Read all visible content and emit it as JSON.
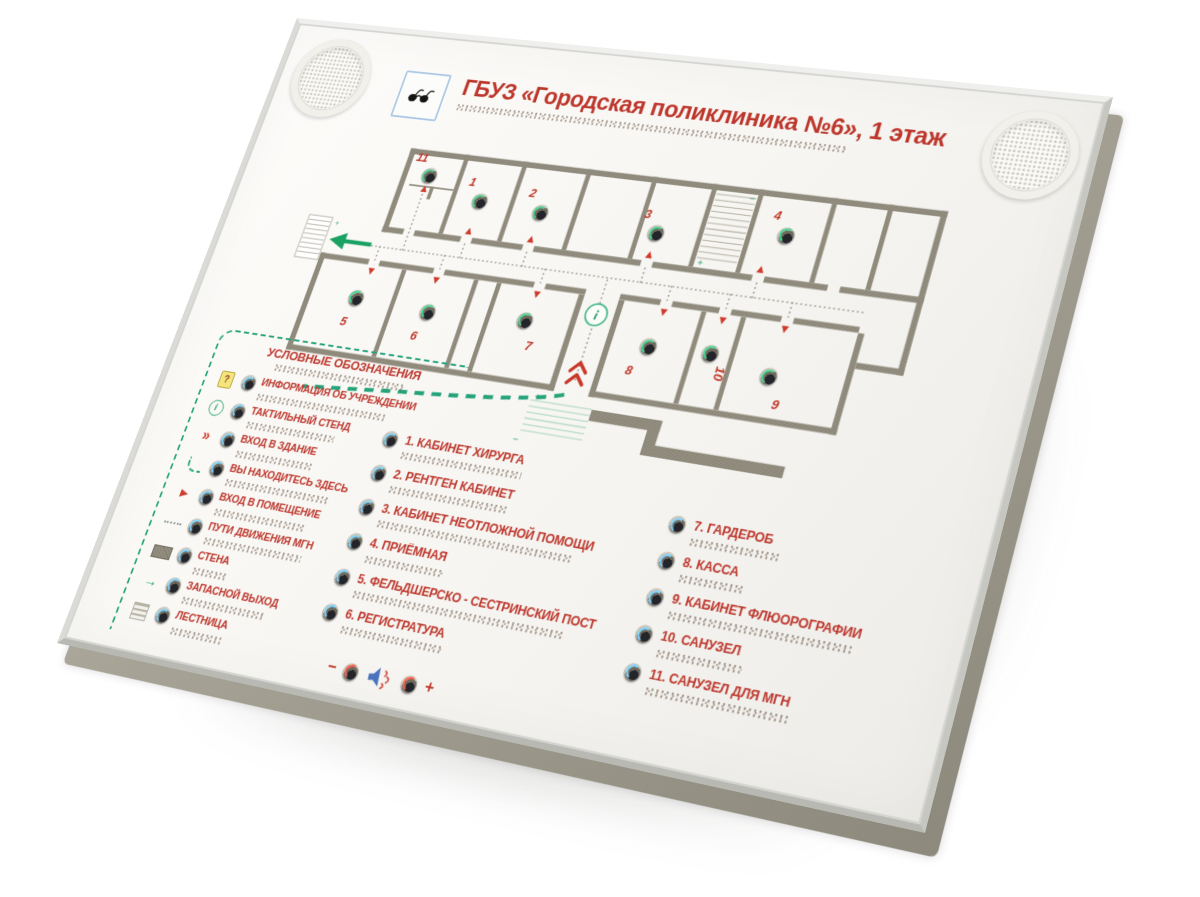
{
  "board": {
    "title": "ГБУЗ «Городская поликлиника №6», 1 этаж"
  },
  "legend": {
    "title": "УСЛОВНЫЕ ОБОЗНАЧЕНИЯ",
    "icons": {
      "question": "?",
      "info": "i",
      "chevron": "»",
      "green_arrow": "→"
    },
    "items": [
      {
        "icon": "question-sign-icon",
        "label": "ИНФОРМАЦИЯ ОБ УЧРЕЖДЕНИИ"
      },
      {
        "icon": "info-point-icon",
        "label": "ТАКТИЛЬНЫЙ СТЕНД"
      },
      {
        "icon": "double-chevron-icon",
        "label": "ВХОД В ЗДАНИЕ"
      },
      {
        "icon": "dashed-route-end-icon",
        "label": "ВЫ НАХОДИТЕСЬ ЗДЕСЬ"
      },
      {
        "icon": "entry-arrow-icon",
        "label": "ВХОД В ПОМЕЩЕНИЕ"
      },
      {
        "icon": "dotted-route-icon",
        "label": "ПУТИ ДВИЖЕНИЯ МГН"
      },
      {
        "icon": "wall-swatch-icon",
        "label": "СТЕНА"
      },
      {
        "icon": "exit-arrow-icon",
        "label": "ЗАПАСНОЙ ВЫХОД"
      },
      {
        "icon": "stairs-swatch-icon",
        "label": "ЛЕСТНИЦА"
      }
    ]
  },
  "rooms_left": [
    {
      "label": "1. КАБИНЕТ ХИРУРГА"
    },
    {
      "label": "2. РЕНТГЕН КАБИНЕТ"
    },
    {
      "label": "3. КАБИНЕТ НЕОТЛОЖНОЙ ПОМОЩИ"
    },
    {
      "label": "4. ПРИЁМНАЯ"
    },
    {
      "label": "5. ФЕЛЬДШЕРСКО - СЕСТРИНСКИЙ ПОСТ"
    },
    {
      "label": "6. РЕГИСТРАТУРА"
    }
  ],
  "rooms_right": [
    {
      "label": "7. ГАРДЕРОБ"
    },
    {
      "label": "8. КАССА"
    },
    {
      "label": "9. КАБИНЕТ ФЛЮОРОГРАФИИ"
    },
    {
      "label": "10. САНУЗЕЛ"
    },
    {
      "label": "11. САНУЗЕЛ ДЛЯ МГН"
    }
  ],
  "plan": {
    "markers": [
      "1",
      "2",
      "3",
      "4",
      "5",
      "6",
      "7",
      "8",
      "9",
      "10",
      "11"
    ],
    "info": "i",
    "plus": "+",
    "minus": "−"
  },
  "volume": {
    "minus": "−",
    "plus": "+"
  },
  "colors": {
    "accent_red": "#bd362c",
    "accent_green": "#25a37a",
    "wall_gray": "#938e80"
  }
}
